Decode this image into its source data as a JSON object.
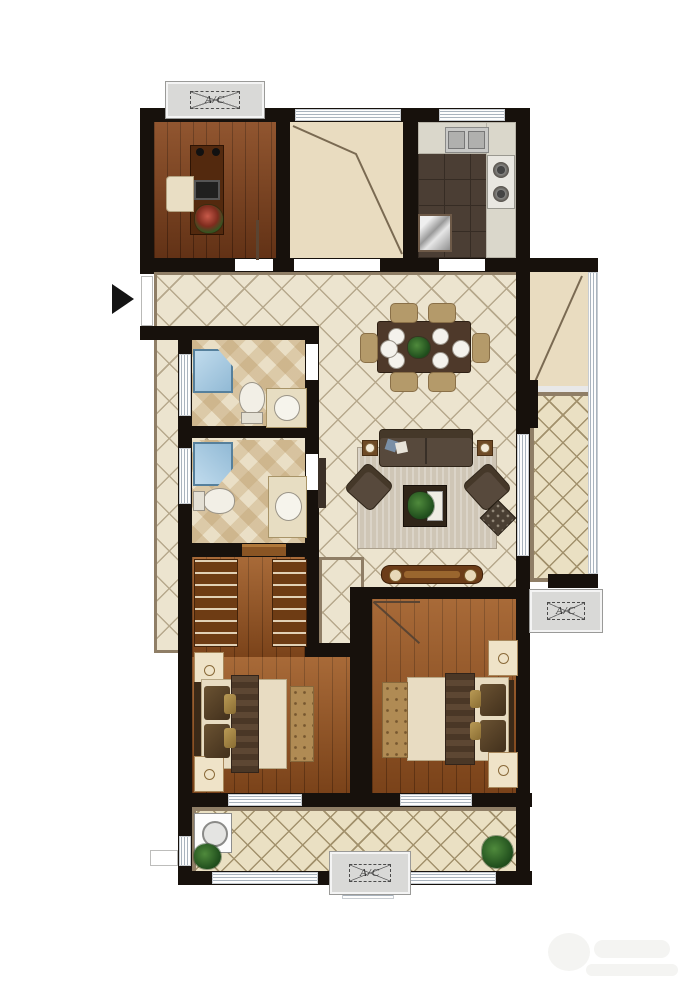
{
  "title": "Apartment floor plan",
  "ac_units": [
    {
      "id": "top-left",
      "label": "A/C"
    },
    {
      "id": "right",
      "label": "A/C"
    },
    {
      "id": "bottom",
      "label": "A/C"
    }
  ],
  "icons": {
    "entry_arrow": "right-pointing solid triangle at entrance"
  },
  "rooms": [
    {
      "name": "study",
      "floor": "hardwood",
      "furniture": [
        "desk-bookshelf-unit",
        "office-chair",
        "laptop",
        "potted-flower",
        "wall-lamps"
      ]
    },
    {
      "name": "flex-room",
      "floor": "bare-screed",
      "furniture": []
    },
    {
      "name": "kitchen",
      "floor": "dark-tile",
      "furniture": [
        "double-basin-sink",
        "two-burner-stove",
        "refrigerator",
        "l-counter"
      ]
    },
    {
      "name": "entry-hall",
      "floor": "diagonal-tile",
      "furniture": []
    },
    {
      "name": "living-dining",
      "floor": "diagonal-tile",
      "furniture": [
        "dining-table-six-seats",
        "dinnerware",
        "three-seat-sofa",
        "two-armchairs",
        "coffee-table-with-plant",
        "area-rug",
        "side-tables-with-lamps",
        "ottoman",
        "tv-console",
        "tall-cabinet"
      ]
    },
    {
      "name": "bathroom-upper",
      "floor": "checker-tile",
      "furniture": [
        "corner-shower",
        "toilet",
        "vanity-sink"
      ]
    },
    {
      "name": "bathroom-lower",
      "floor": "checker-tile",
      "furniture": [
        "corner-shower",
        "toilet",
        "vanity-sink"
      ]
    },
    {
      "name": "master-bedroom",
      "floor": "hardwood",
      "furniture": [
        "wardrobe-left",
        "wardrobe-right",
        "double-bed",
        "nightstand-upper",
        "nightstand-lower",
        "bench"
      ]
    },
    {
      "name": "bedroom-2",
      "floor": "hardwood",
      "furniture": [
        "double-bed",
        "nightstand-upper",
        "nightstand-lower",
        "bench"
      ]
    },
    {
      "name": "balcony-right",
      "floor": "lattice-tile",
      "furniture": []
    },
    {
      "name": "balcony-bottom",
      "floor": "lattice-tile",
      "furniture": [
        "washing-machine",
        "potted-plant-left",
        "potted-plant-right"
      ]
    }
  ],
  "colors": {
    "wall": "#17110c",
    "hall_tile": "#ece4cf",
    "balcony_tile": "#eae0c3",
    "hardwood": "#95511f",
    "kitchen_tile": "#4b3e34",
    "shower_blue": "#a9cde4",
    "platform_gray": "#d9d9d7",
    "trim_taupe": "#8f7e66"
  },
  "watermark": {
    "note": "faint illegible logo, bottom-right"
  }
}
